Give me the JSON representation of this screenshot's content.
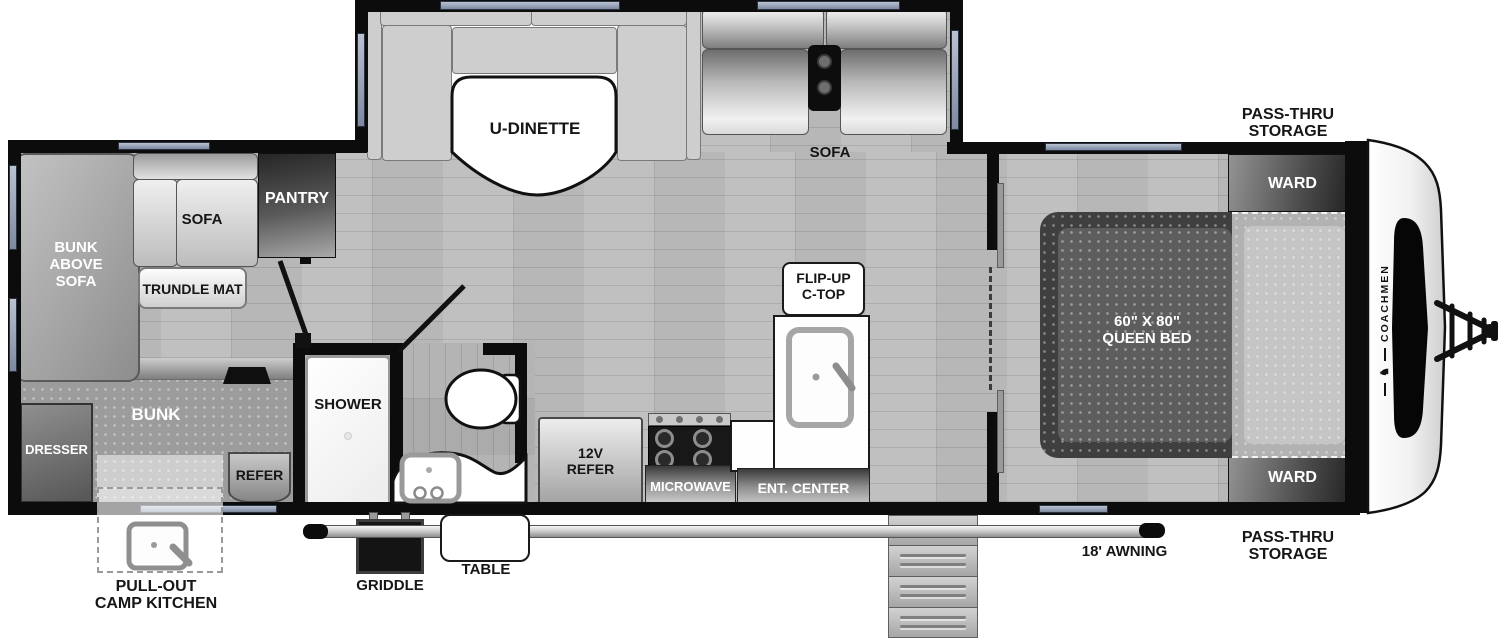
{
  "labels": {
    "pass_thru_top": [
      "PASS-THRU",
      "STORAGE"
    ],
    "pass_thru_bottom": [
      "PASS-THRU",
      "STORAGE"
    ],
    "ward_top": "WARD",
    "ward_bottom": "WARD",
    "queen_bed": [
      "60\" X 80\"",
      "QUEEN BED"
    ],
    "awning": "18' AWNING",
    "u_dinette": "U-DINETTE",
    "sofa_slideout": "SOFA",
    "flip_up_ctop": [
      "FLIP-UP",
      "C-TOP"
    ],
    "ent_center": "ENT. CENTER",
    "microwave": "MICROWAVE",
    "refer_12v": [
      "12V",
      "REFER"
    ],
    "shower": "SHOWER",
    "griddle": "GRIDDLE",
    "table": "TABLE",
    "bunk_above_sofa": [
      "BUNK",
      "ABOVE",
      "SOFA"
    ],
    "sofa_rear": "SOFA",
    "pantry": "PANTRY",
    "trundle_mat": "TRUNDLE MAT",
    "bunk": "BUNK",
    "dresser": "DRESSER",
    "refer_bunk": "REFER",
    "pull_out_camp_kitchen": [
      "PULL-OUT",
      "CAMP KITCHEN"
    ],
    "brand": "COACHMEN"
  },
  "icons": {
    "brand_emblem": "♞"
  },
  "colors": {
    "wall": "#0c0c0c",
    "window": "#97a3b6",
    "floor": "#b7b7b7",
    "dark_cabinet": "#2e2e2e",
    "label_dark": "#161616",
    "label_light": "#ffffff"
  }
}
